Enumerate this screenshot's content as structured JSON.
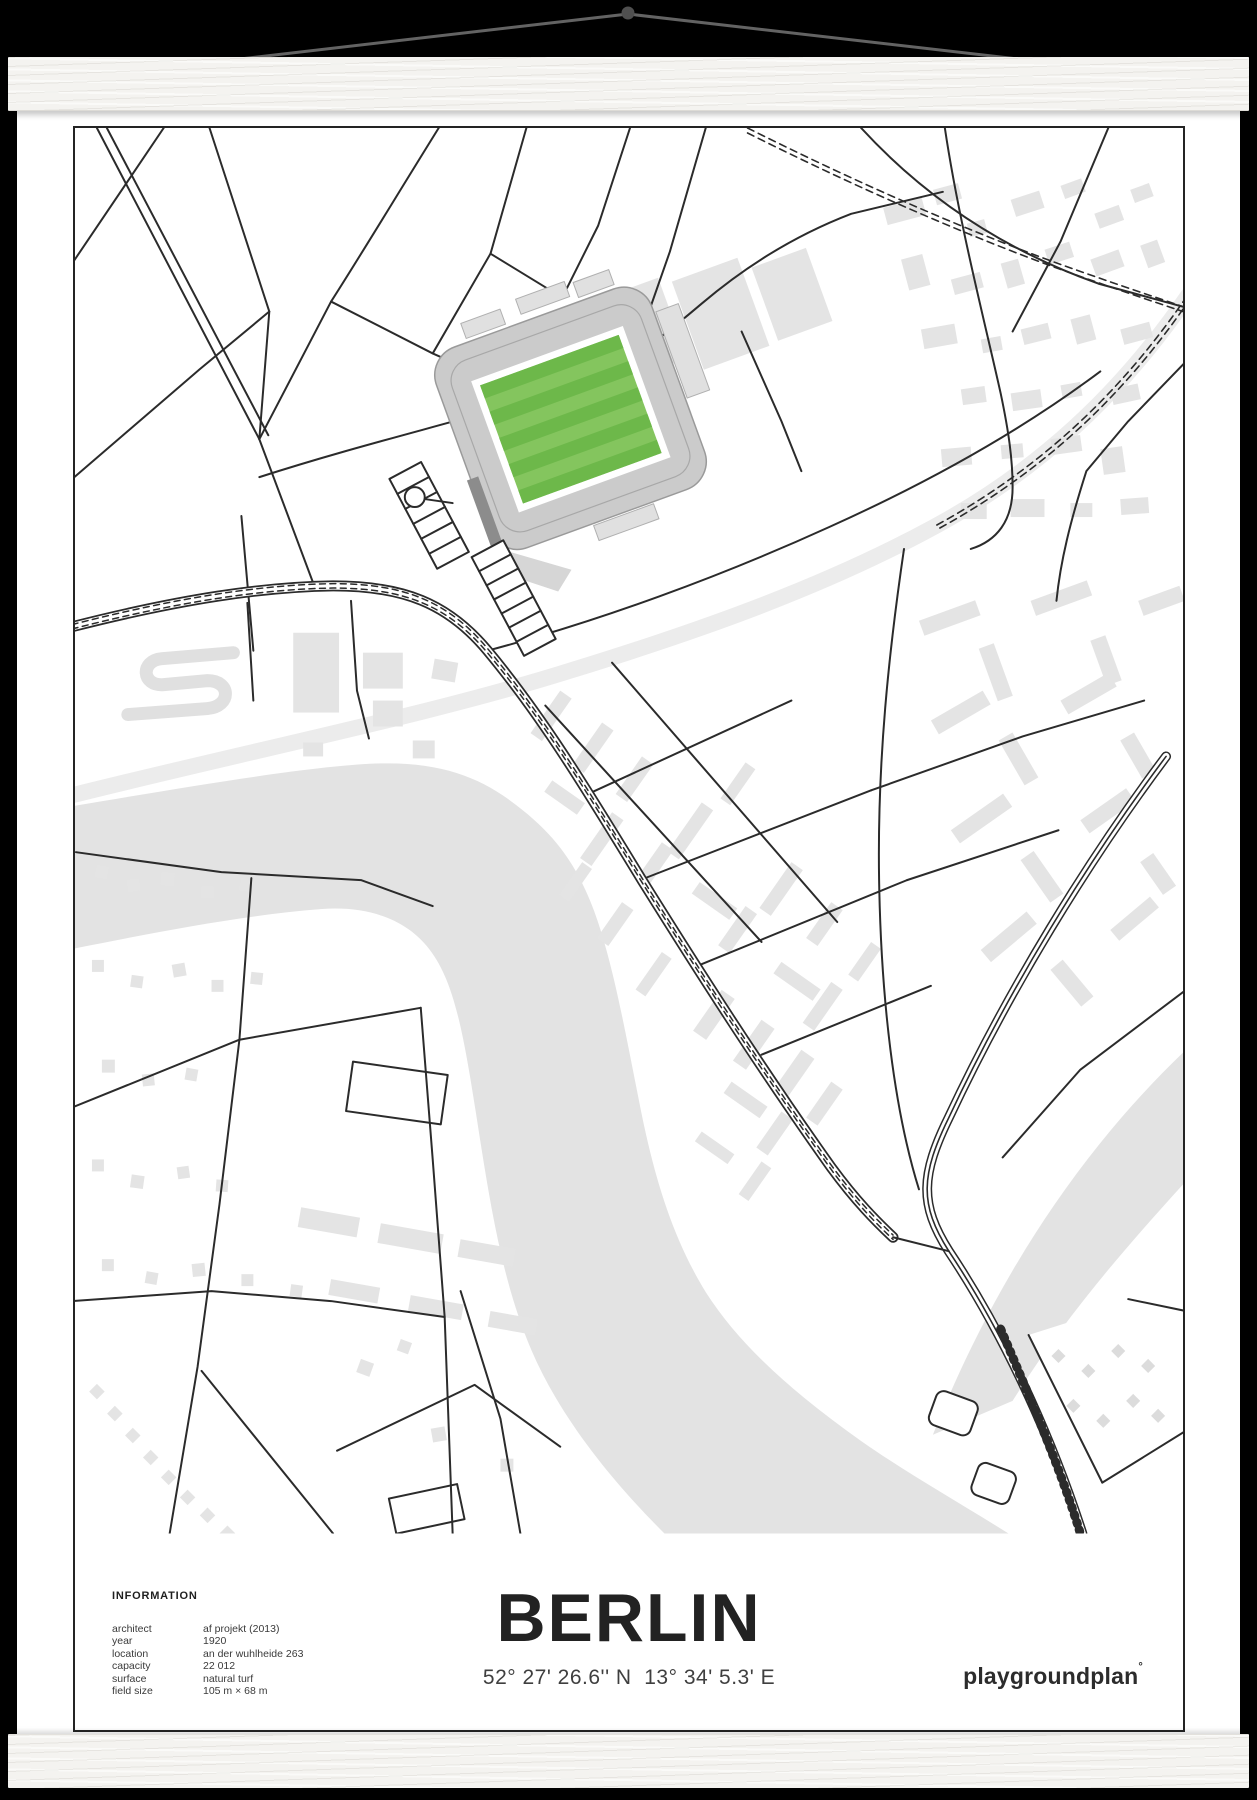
{
  "poster": {
    "info": {
      "heading": "INFORMATION",
      "rows": [
        {
          "label": "architect",
          "value": "af projekt (2013)"
        },
        {
          "label": "year",
          "value": "1920"
        },
        {
          "label": "location",
          "value": "an der wuhlheide 263"
        },
        {
          "label": "capacity",
          "value": "22 012"
        },
        {
          "label": "surface",
          "value": "natural turf"
        },
        {
          "label": "field size",
          "value": "105 m × 68 m"
        }
      ]
    },
    "title": "BERLIN",
    "coordinates": "52° 27' 26.6'' N  13° 34' 5.3' E",
    "brand": "playgroundplan",
    "brand_mark": "°"
  },
  "map": {
    "pitch_color_light": "#84c55e",
    "pitch_color_dark": "#6db84a",
    "water_color": "#e3e3e3",
    "building_color": "#e4e4e4",
    "road_color": "#2b2b2b",
    "rail_corridor_color": "#ececec"
  },
  "scene": {
    "background": "#000000",
    "hanger_color": "#f4f3f0",
    "string_color": "#636363"
  }
}
